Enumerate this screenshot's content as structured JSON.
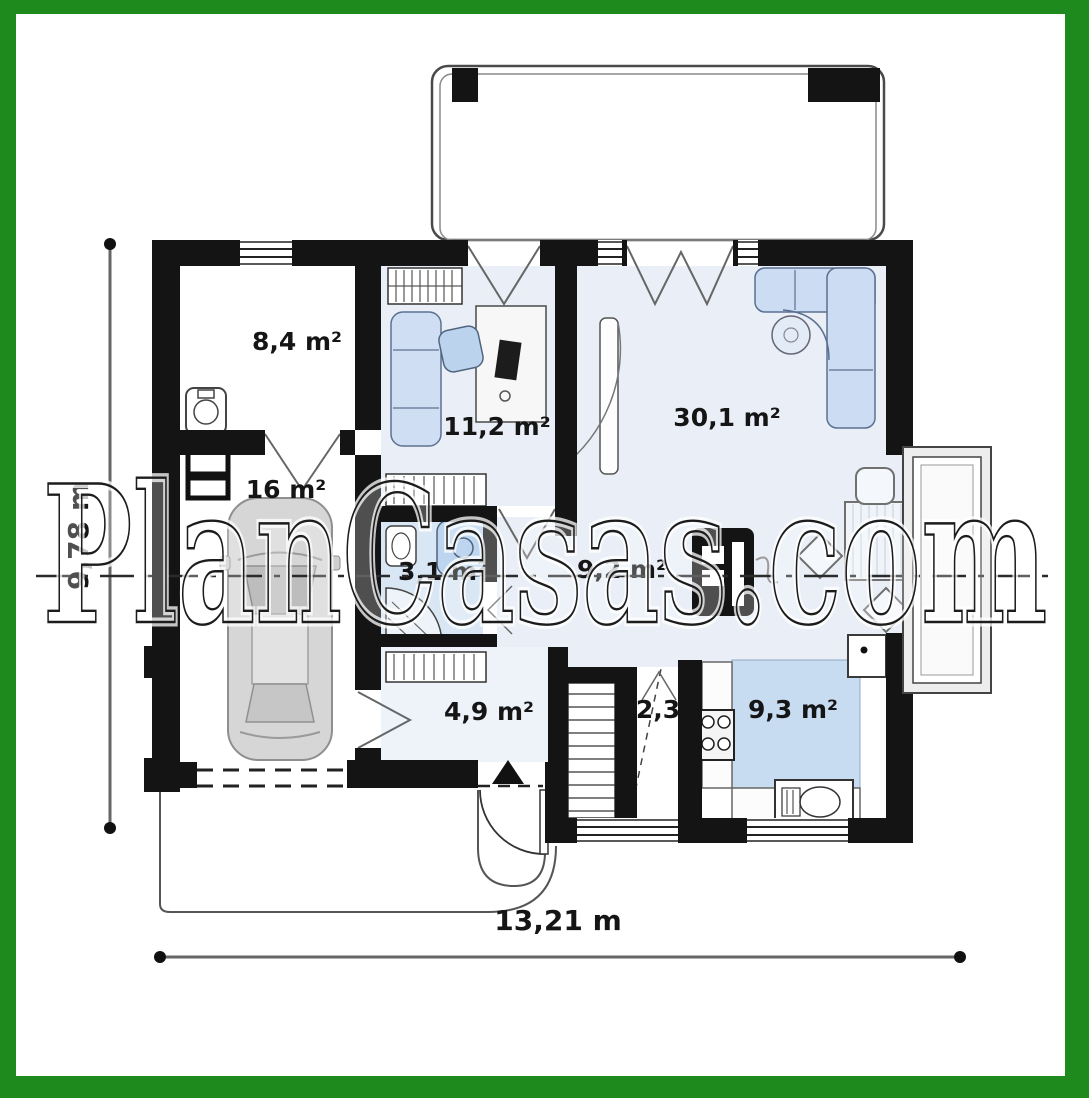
{
  "title": "house-ground-floor-plan",
  "watermark": "PlanCasas.com",
  "colors": {
    "frame_green": "#1e8a1e",
    "wall_black": "#141414",
    "floor_blue": "#e9eef7",
    "furniture_blue": "#ccdcf2",
    "kitchen_blue": "#c7dcf1",
    "bathroom_blue": "#d9e6f4"
  },
  "rooms": [
    {
      "name": "storage-room",
      "area_label": "8,4 m²"
    },
    {
      "name": "garage",
      "area_label": "16 m²"
    },
    {
      "name": "entry-hall",
      "area_label": "11,2 m²"
    },
    {
      "name": "living-room",
      "area_label": "30,1 m²"
    },
    {
      "name": "bathroom",
      "area_label": "3,1 m²"
    },
    {
      "name": "hallway",
      "area_label": "9,2 m²"
    },
    {
      "name": "vestibule",
      "area_label": "4,9 m²"
    },
    {
      "name": "corridor",
      "area_label": "2,3"
    },
    {
      "name": "kitchen",
      "area_label": "9,3 m²"
    }
  ],
  "dimensions": {
    "overall_width": "13,21 m",
    "overall_height": "9,78 m"
  }
}
